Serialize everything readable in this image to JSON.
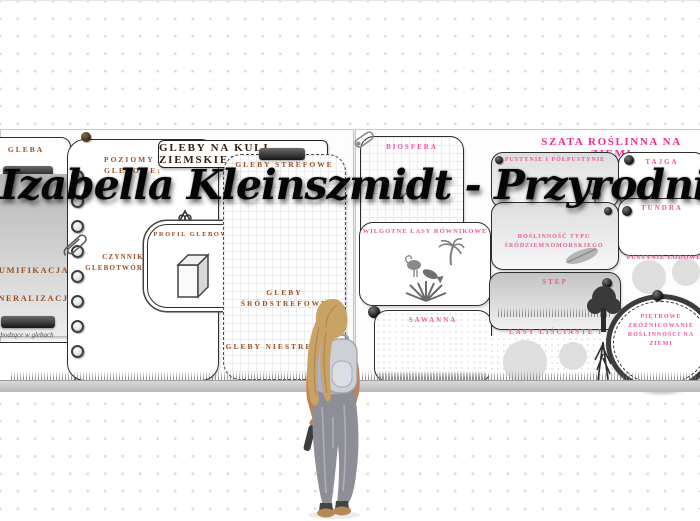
{
  "watermark": {
    "text": "Izabella Kleinszmidt - PrzyrodniczeEcho"
  },
  "soil_poster": {
    "title": "GLEBY NA KULI ZIEMSKIEJ",
    "gleba": "GLEBA",
    "poziomy": "POZIOMY GLEBOWE:",
    "czynniki": "CZYNNIKI GLEBOTWÓRCZE:",
    "profil": "PROFIL GLEBOWY",
    "humifikacja": "HUMIFIKACJA",
    "mineralizacja": "MINERALIZACJA",
    "procesy": "Procesy zachodzące w glebach",
    "strefowe": "GLEBY STREFOWE",
    "srodstrefowe": "GLEBY ŚRÓDSTREFOWE",
    "niestrefowe": "GLEBY NIESTREFOWE"
  },
  "vegetation_poster": {
    "title": "SZATA ROŚLINNA NA ZIEMI",
    "biosfera": "BIOSFERA",
    "wilgotne_lasy": "WILGOTNE LASY RÓWNIKOWE",
    "sawanna": "SAWANNA",
    "pustynie": "PUSTYNIE I PÓŁPUSTYNIE",
    "srodziemnomorska": "ROŚLINNOŚĆ TYPU ŚRÓDZIEMNOMORSKIEGO",
    "step": "STEP",
    "lasy_lisciaste": "LASY LIŚCIASTE I MIESZANE",
    "tajga": "TAJGA",
    "tundra": "TUNDRA",
    "pustynie_lodowe": "PUSTYNIE LODOWE",
    "pietrowe": "PIĘTROWE ZRÓŻNICOWANIE ROŚLINNOŚCI NA ZIEMI"
  },
  "colors": {
    "soil_label_brown": "#9a4f24",
    "soil_title_brown": "#34200e",
    "vegetation_pink": "#f0569f",
    "vegetation_title_pink": "#ef2d92",
    "watermark_black": "#050505"
  }
}
